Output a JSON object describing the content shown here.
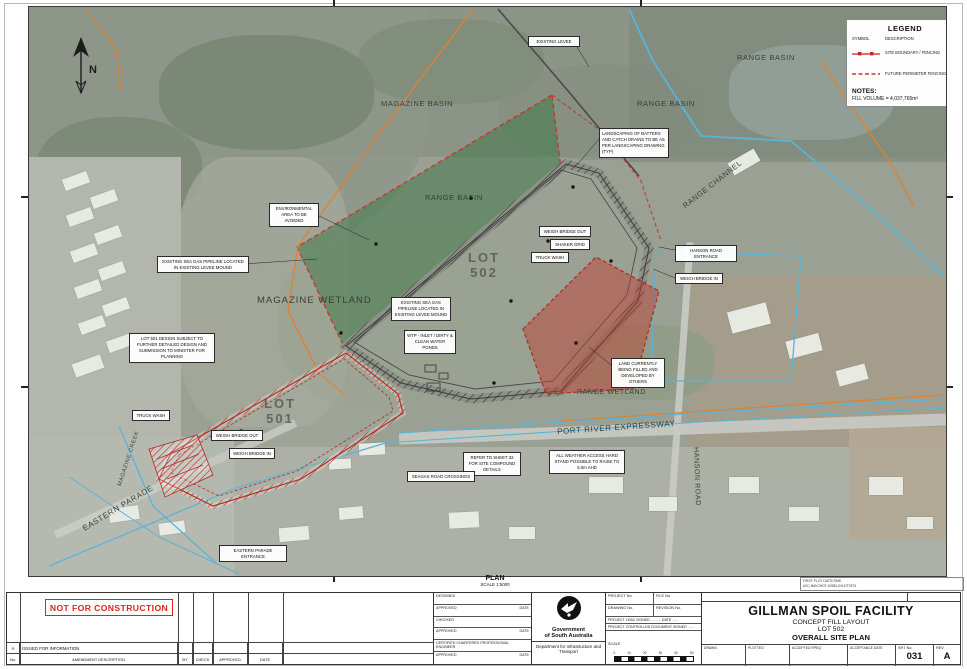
{
  "sheet": {
    "plan_label": "PLAN",
    "plan_scale": "SCALE 1:5000",
    "plot_info_line1": "FIRST PLOT DATE/TIME",
    "plot_info_line2": "A2C-NAVCHDT-00381-EH-DT0T01"
  },
  "legend": {
    "title": "LEGEND",
    "symbol_header": "SYMBOL",
    "description_header": "DESCRIPTION",
    "items": [
      {
        "description": "SITE BOUNDARY / FENCING"
      },
      {
        "description": "FUTURE PERIMETER FENCING"
      }
    ],
    "notes_title": "NOTES:",
    "notes_text": "FILL VOLUME = 4,037,765m³"
  },
  "map": {
    "north_label": "N",
    "area_labels": [
      {
        "text": "MAGAZINE BASIN"
      },
      {
        "text": "RANGE BASIN"
      },
      {
        "text": "RANGE BASIN"
      },
      {
        "text": "RANGE BASIN"
      },
      {
        "text": "MAGAZINE WETLAND"
      },
      {
        "text": "RANGE WETLAND"
      },
      {
        "text": "RANGE CHANNEL"
      },
      {
        "text": "LOT 502"
      },
      {
        "text": "LOT 501"
      },
      {
        "text": "PORT RIVER EXPRESSWAY"
      },
      {
        "text": "HANSON ROAD"
      },
      {
        "text": "EASTERN PARADE"
      },
      {
        "text": "MAGAZINE CREEK"
      }
    ],
    "callouts": [
      {
        "text": "EXISTING LEVEE"
      },
      {
        "text": "LANDSCAPING OF BATTERS AND CATCH DRAINS TO BE AS PER LANDSCAPING DRAWING (TYP)"
      },
      {
        "text": "ENVIRONMENTAL AREA TO BE AVOIDED"
      },
      {
        "text": "WEIGH BRIDGE OUT"
      },
      {
        "text": "SHAKER GRID"
      },
      {
        "text": "TRUCK WASH"
      },
      {
        "text": "EXISTING SEA GAS PIPELINE LOCATED IN EXISTING LEVEE MOUND"
      },
      {
        "text": "EXISTING SEA GAS PIPELINE LOCATED IN EXISTING LEVEE MOUND"
      },
      {
        "text": "WTP - INLET / DIRTY & CLEAN WATER PONDS"
      },
      {
        "text": "LOT 501 DESIGN SUBJECT TO FURTHER DETAILED DESIGN AND SUBMISSION TO MINISTER FOR PLANNING"
      },
      {
        "text": "HANSON ROAD ENTRANCE"
      },
      {
        "text": "WEIGH BRIDGE IN"
      },
      {
        "text": "LAND CURRENTLY BEING FILLED AND DEVELOPED BY OTHERS"
      },
      {
        "text": "TRUCK WASH"
      },
      {
        "text": "WEIGH BRIDGE OUT"
      },
      {
        "text": "WEIGH BRIDGE IN"
      },
      {
        "text": "REFER TO SHEET 32 FOR SITE COMPOUND DETAILS"
      },
      {
        "text": "ALL WEATHER ACCESS HARD STAND POSSIBLE TO RAISE TO 5.0m AHD"
      },
      {
        "text": "SEAGAS ROAD CROSSINGS"
      },
      {
        "text": "EASTERN PARADE ENTRANCE"
      }
    ],
    "colors": {
      "site_boundary_red": "#c1271e",
      "future_fence_red": "#d0352a",
      "environmental_green": "#3a7642",
      "filled_land_red": "#be3c30",
      "pipeline_orange": "#df8132",
      "drainage_cyan": "#5ab4d6"
    }
  },
  "title_block": {
    "stamp": "NOT FOR CONSTRUCTION",
    "rev_no": "A",
    "rev_desc": "ISSUED FOR INFORMATION",
    "headers": {
      "no": "No.",
      "desc": "AMENDMENT DESCRIPTION",
      "by": "BY",
      "check": "CHECK",
      "approved": "APPROVED",
      "date": "DATE"
    },
    "cert_rows": [
      {
        "a": "DESIGNED",
        "b": ""
      },
      {
        "a": "APPROVED",
        "b": "DATE"
      },
      {
        "a": "CHECKED",
        "b": ""
      },
      {
        "a": "APPROVED",
        "b": "DATE"
      },
      {
        "a": "CERTIFIED CHARTERED PROFESSIONAL ENGINEER",
        "b": ""
      },
      {
        "a": "APPROVED",
        "b": "DATE"
      }
    ],
    "agency": {
      "l1": "Government",
      "l2": "of South Australia",
      "dept": "Department for Infrastructure and Transport"
    },
    "project": {
      "project_no": "PROJECT No.",
      "file_no": "FILE No.",
      "drawing_no": "DRAWING No.",
      "revision_no": "REVISION No.",
      "lead": "PROJECT LEAD  SIGNED ..........  DATE ......",
      "controlled": "PROJECT CONTROLLED DOCUMENT  SIGNED ......",
      "scale_label": "SCALE",
      "scale_ticks": [
        "0",
        "10",
        "20",
        "30",
        "40",
        "50"
      ]
    },
    "title": {
      "l1": "GILLMAN SPOIL FACILITY",
      "l2": "CONCEPT FILL LAYOUT",
      "l3": "LOT 502",
      "l4": "OVERALL SITE PLAN"
    },
    "bottom": {
      "c1": "DRAWN",
      "c2": "PLOTTED",
      "c3": "ACCEPTED RPEQ",
      "c4": "ACCEPTANCE DATE",
      "sht_label": "SHT No.",
      "sht": "031",
      "rev_label": "REV",
      "rev": "A"
    }
  }
}
